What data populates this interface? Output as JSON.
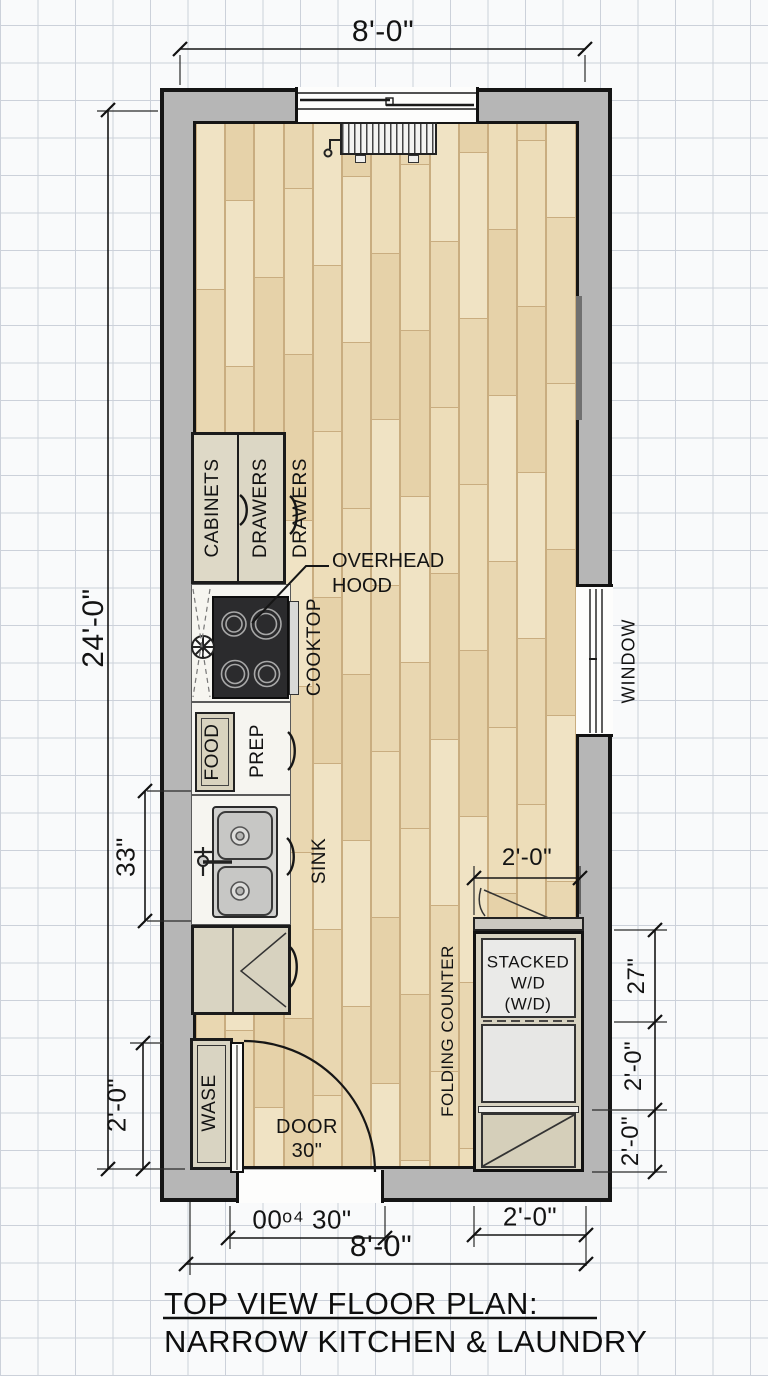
{
  "title": {
    "line1": "TOP VIEW FLOOR PLAN:",
    "line2": "NARROW KITCHEN & LAUNDRY"
  },
  "dimensions": {
    "top_width": "8'-0\"",
    "left_height": "24'-0\"",
    "sink_run": "33\"",
    "waste_left": "2'-0\"",
    "laundry_top": "2'-0\"",
    "right_wd": "27\"",
    "right_dryer": "2'-0\"",
    "right_cabinet": "2'-0\"",
    "door_bottom": "00ᵒ⁴ 30\"",
    "bottom_right": "2'-0\"",
    "bottom_width": "8'-0\""
  },
  "labels": {
    "cabinets": "CABINETS",
    "drawers_cabinet": "DRAWERS",
    "drawers_floor": "DRAWERS",
    "overhead_hood_line1": "OVERHEAD",
    "overhead_hood_line2": "HOOD",
    "cooktop": "COOKTOP",
    "food": "FOOD",
    "prep": "PREP",
    "sink": "SINK",
    "waste": "WASE",
    "door_line1": "DOOR",
    "door_line2": "30\"",
    "folding_counter": "FOLDING COUNTER",
    "stacked_wd_line1": "STACKED",
    "stacked_wd_line2": "W/D",
    "stacked_wd_line3": "(W/D)",
    "window": "WINDOW"
  },
  "colors": {
    "wall_fill": "#b6b6b6",
    "wall_outline": "#151515",
    "floor": "#ecdcb8",
    "plank_line": "#c9ad80",
    "cooktop": "#2b2b2d",
    "counter": "#f6f5f0",
    "grid": "#ccd1da",
    "paper": "#f9fafb"
  }
}
